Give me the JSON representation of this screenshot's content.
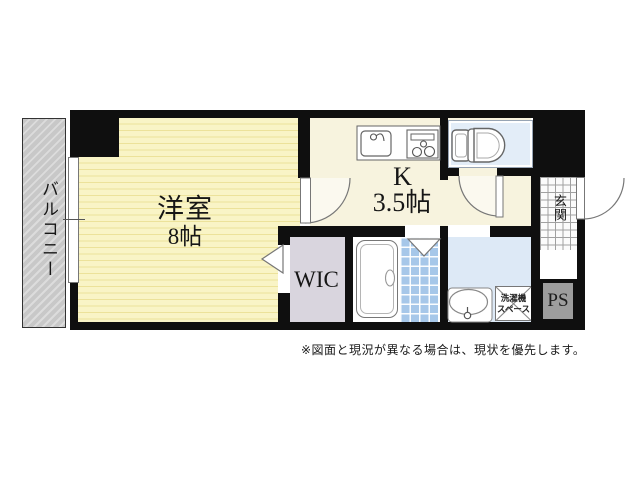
{
  "plan": {
    "rooms": {
      "living": {
        "name": "洋室",
        "size": "8帖"
      },
      "kitchen": {
        "name": "K",
        "size": "3.5帖"
      },
      "wic": {
        "label": "WIC"
      },
      "balcony": {
        "label": "バルコニー"
      },
      "entrance": {
        "label": "玄関"
      },
      "pipe_space": {
        "label": "PS"
      },
      "laundry": {
        "line1": "洗濯機",
        "line2": "スペース"
      }
    },
    "fixtures": {
      "kitchen_sink": "kitchen-sink-icon",
      "gas_stove": "gas-stove-icon",
      "toilet": "toilet-icon",
      "bathtub": "bathtub-icon",
      "wash_basin": "wash-basin-icon",
      "door_swings": "door-swing-icon",
      "folding_doors": "folding-door-icon",
      "window": "sliding-window-icon"
    },
    "note": "※図面と現況が異なる場合は、現状を優先します。"
  },
  "palette": {
    "wall": "#0f0f0f",
    "living_floor": "#f9f4c6",
    "living_stripe": "#ece29a",
    "kitchen_floor": "#f7f3de",
    "wic_floor": "#d9d5de",
    "toilet_floor": "#e3edf8",
    "washroom_floor": "#dde9f6",
    "bath_tile": "#a6c7e9",
    "balcony_floor": "#c8c8c8",
    "entrance_tile": "#fbfbfb",
    "pipe_space_fill": "#9d9d9d"
  }
}
